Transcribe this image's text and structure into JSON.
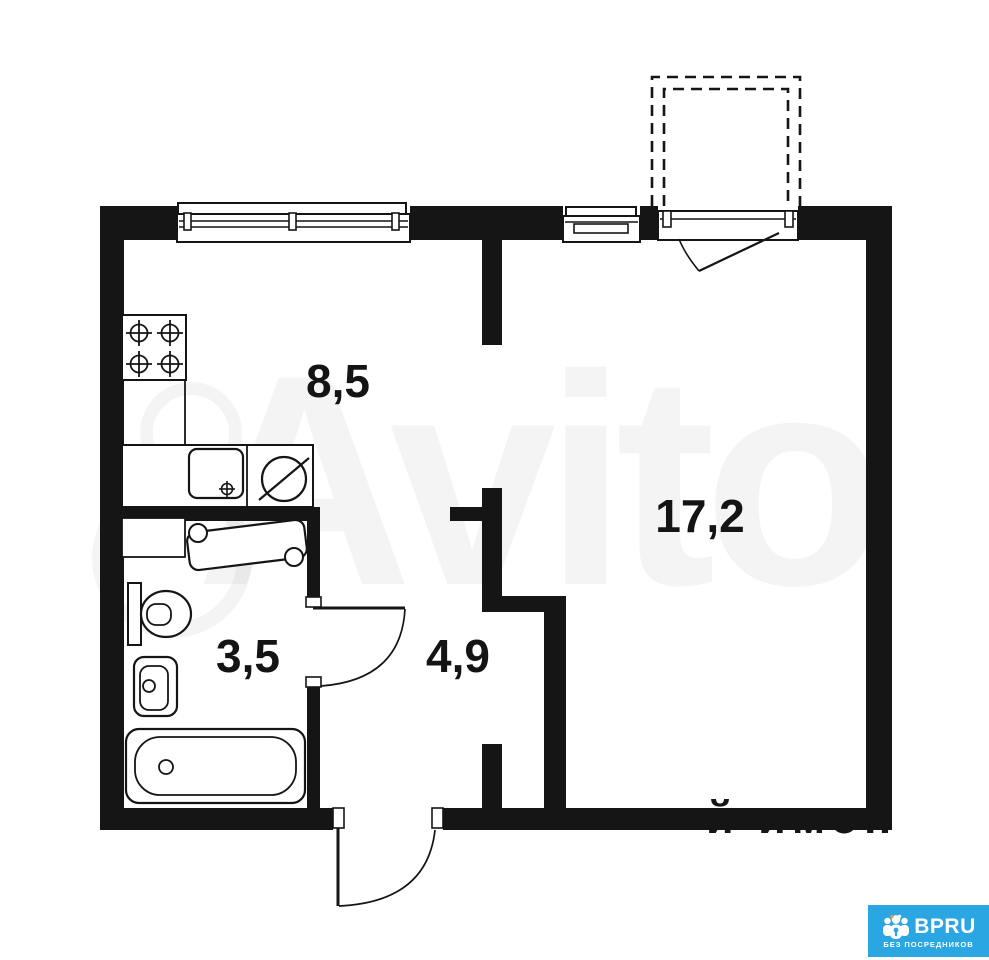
{
  "plan": {
    "type": "apartment-floor-plan",
    "rooms": [
      {
        "id": "kitchen",
        "area_label": "8,5"
      },
      {
        "id": "living-room",
        "area_label": "17,2"
      },
      {
        "id": "bathroom",
        "area_label": "3,5"
      },
      {
        "id": "hallway",
        "area_label": "4,9"
      }
    ],
    "fixtures": [
      "stove-icon",
      "kitchen-sink-icon",
      "fridge-icon",
      "kitchen-counter",
      "washing-machine-icon",
      "bathroom-cabinet",
      "toilet-icon",
      "bathroom-sink-icon",
      "bathtub-icon",
      "kitchen-window-icon",
      "small-window-icon",
      "balcony-door-icon",
      "bathroom-door-icon",
      "entrance-door-icon",
      "balcony-dashed-outline"
    ],
    "colors": {
      "wall": "#151515",
      "background": "#ffffff"
    }
  },
  "watermark": {
    "brand": "Avito",
    "fragment": "й имон",
    "opacity": "0.042"
  },
  "logo": {
    "brand": "BPRU",
    "tagline": "БЕЗ ПОСРЕДНИКОВ",
    "background": "#2AA7E3",
    "text_color": "#ffffff",
    "icon": "people-lock-icon"
  }
}
